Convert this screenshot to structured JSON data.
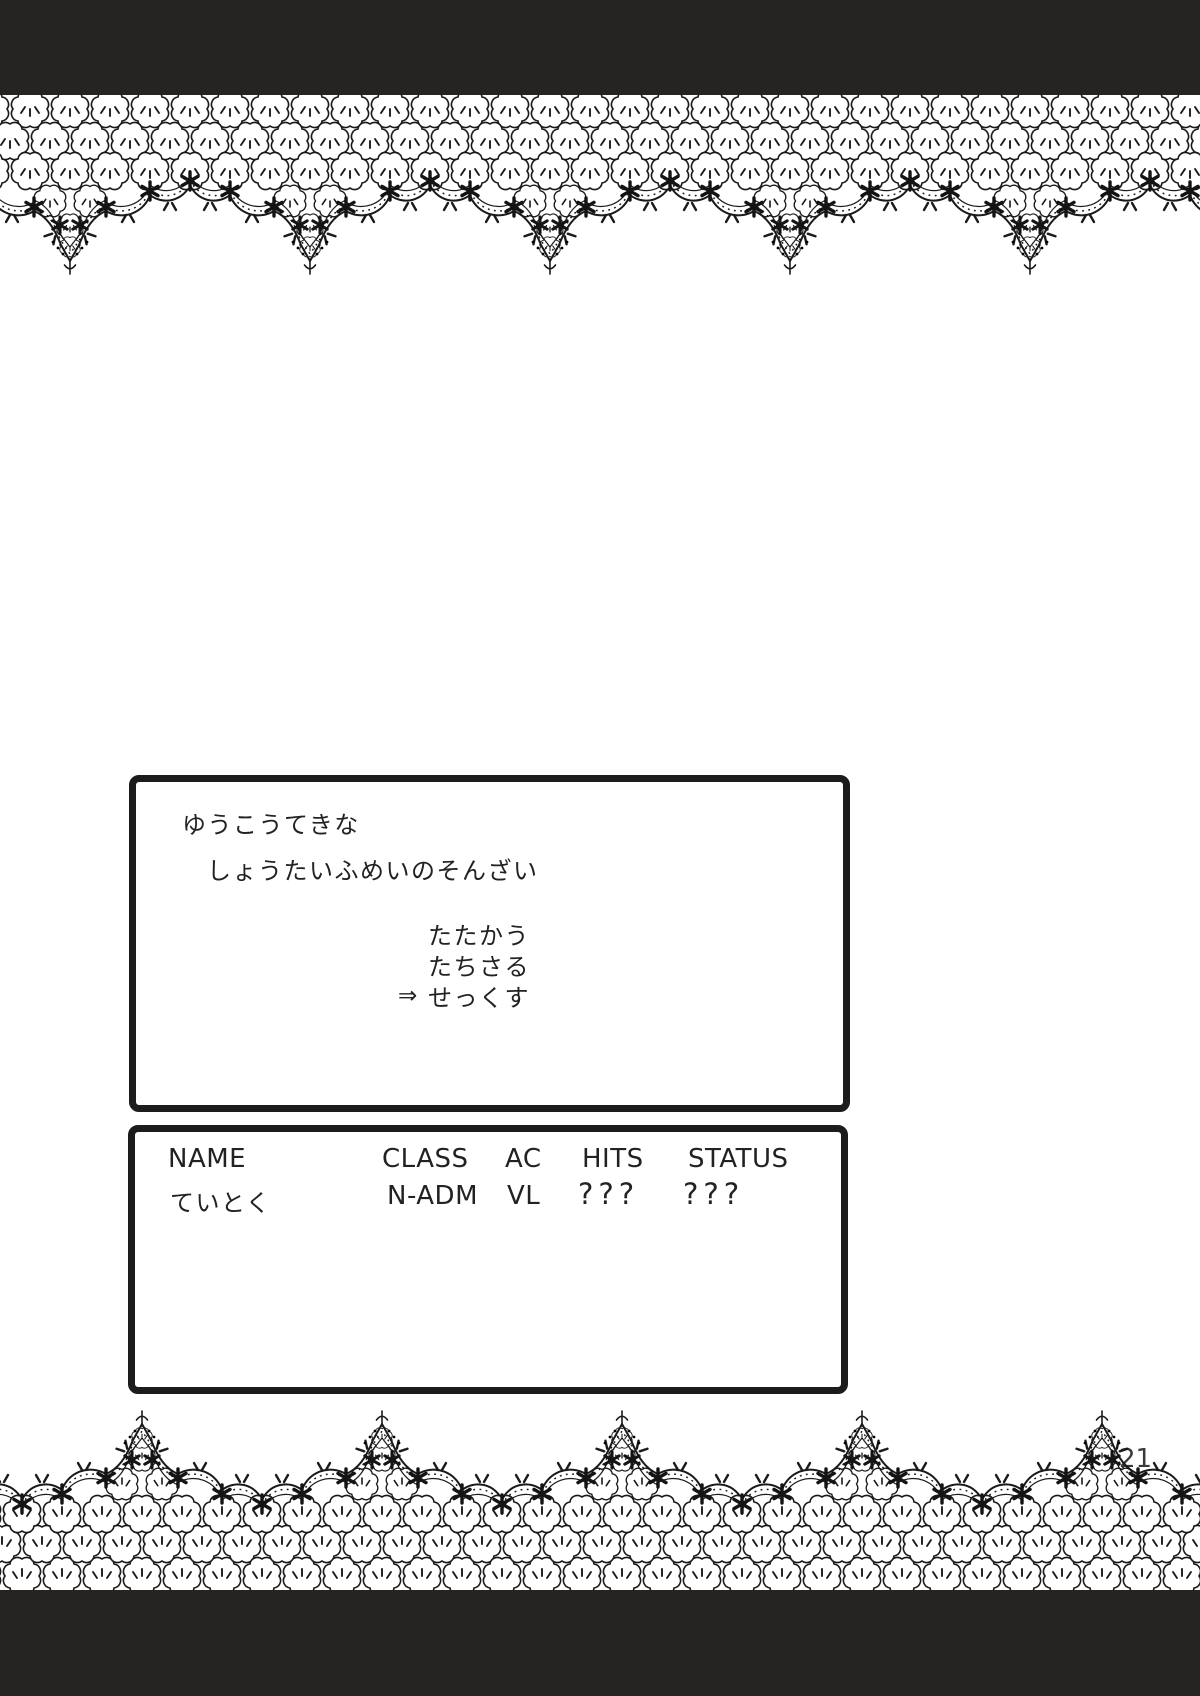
{
  "colors": {
    "ink": "#1d1c1c",
    "paper": "#ffffff",
    "bar": "#262423"
  },
  "battle_dialog": {
    "line1": "ゆうこうてきな",
    "line2": "しょうたいふめいのそんざい",
    "menu_items": [
      {
        "cursor": "",
        "label": "たたかう"
      },
      {
        "cursor": "",
        "label": "たちさる"
      },
      {
        "cursor": "⇒",
        "label": "せっくす"
      }
    ]
  },
  "status_window": {
    "headers": [
      "NAME",
      "CLASS",
      "AC",
      "HITS",
      "STATUS"
    ],
    "rows": [
      {
        "name": "ていとく",
        "class": "N-ADM",
        "ac": "VL",
        "hits": "???",
        "status": "???"
      }
    ]
  },
  "page": {
    "number": "21"
  }
}
